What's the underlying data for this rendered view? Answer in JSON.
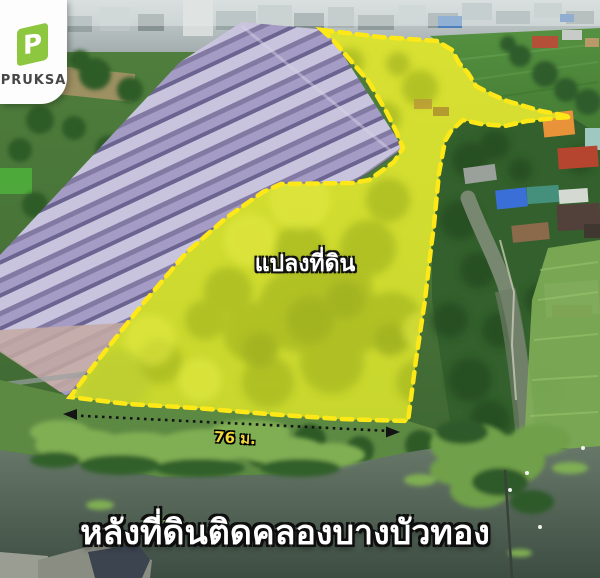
{
  "brand": {
    "name": "PRUKSA",
    "logo_letter": "P",
    "logo_color": "#8dc63f"
  },
  "annotations": {
    "plot_label": "แปลงที่ดิน",
    "measurement": {
      "label": "76 ม.",
      "value": 76,
      "unit": "ม."
    },
    "caption": "หลังที่ดินติดคลองบางบัวทอง"
  },
  "colors": {
    "highlight_border": "#ffe817",
    "highlight_fill": "#d4de38",
    "measurement_text": "#f2d838",
    "caption_text": "#ffffff",
    "housing_roofs": "#b5afd2",
    "canal_water": "#536453"
  }
}
